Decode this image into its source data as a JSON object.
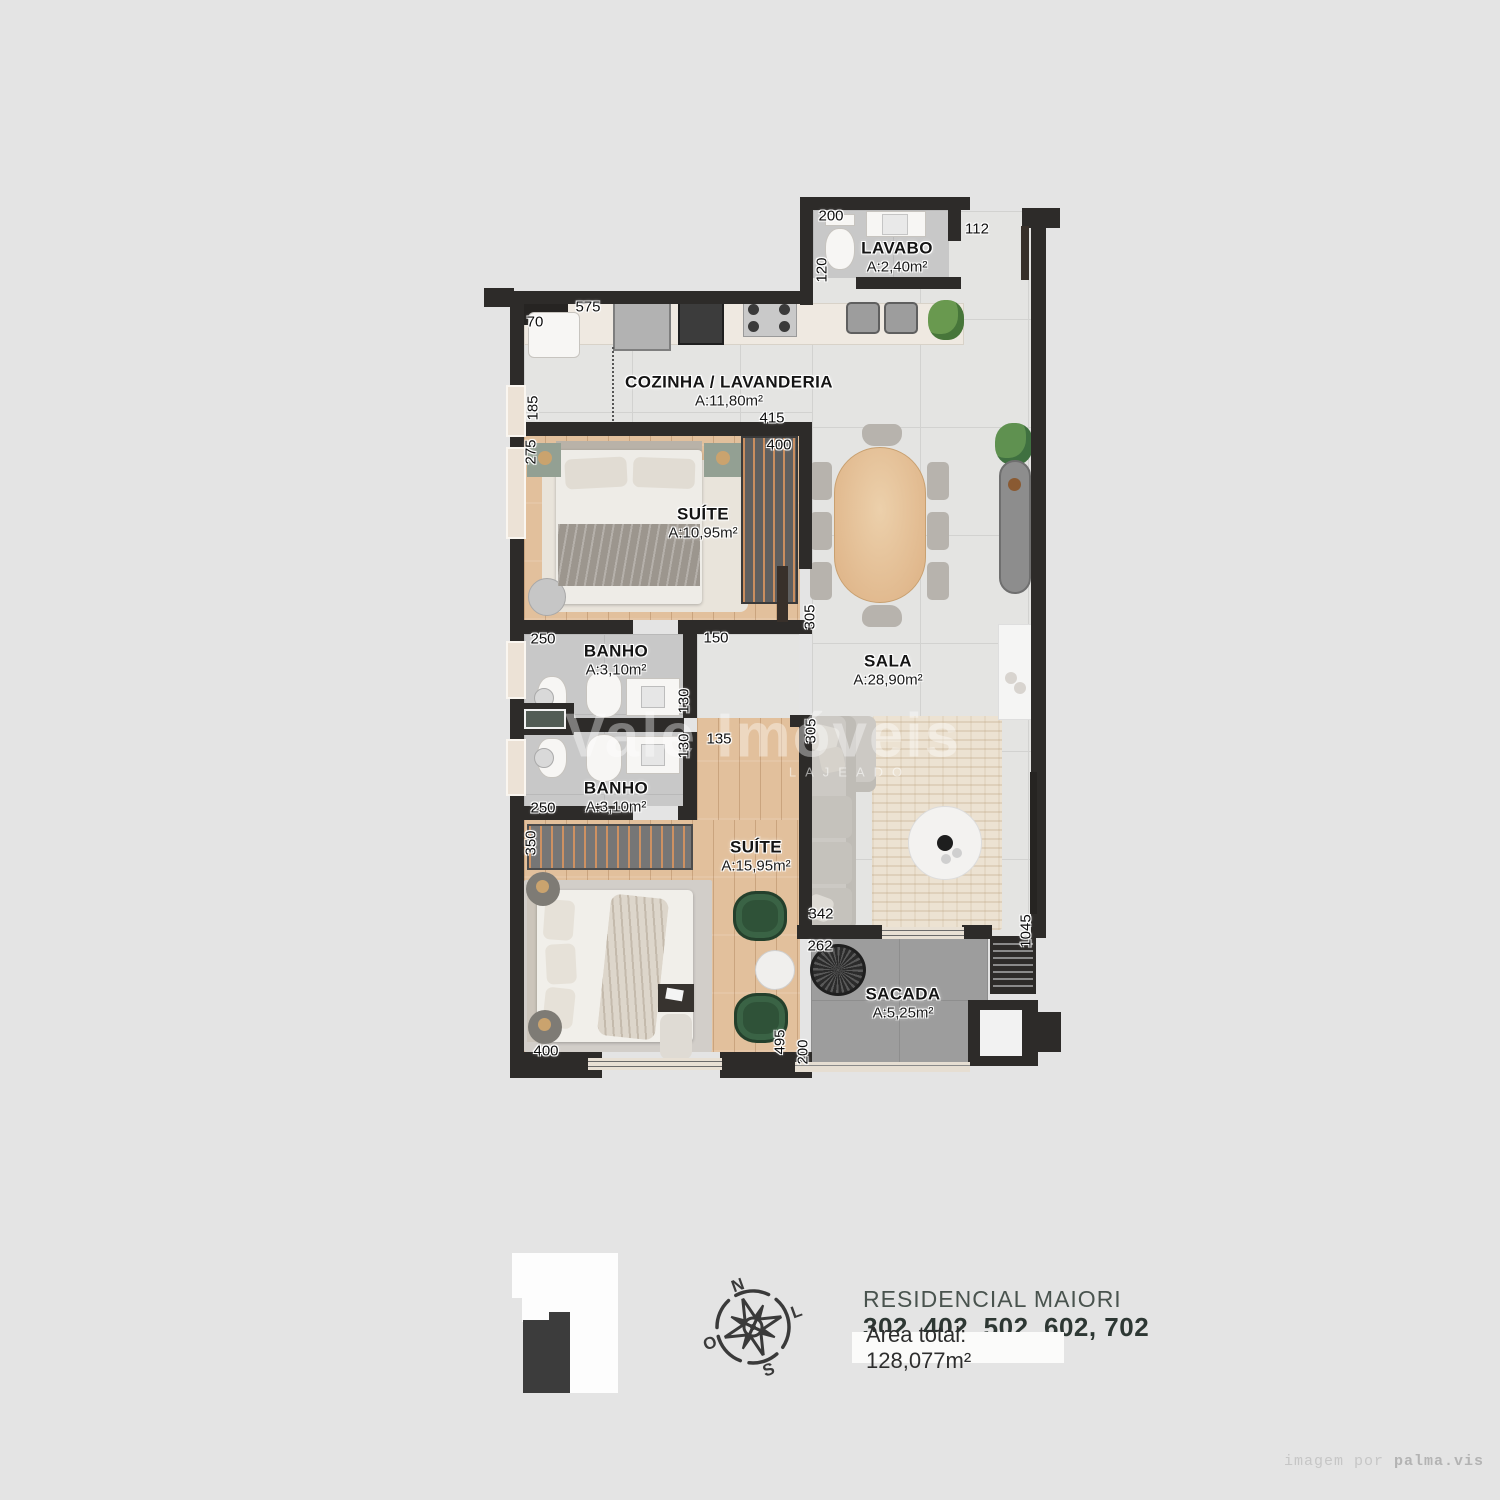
{
  "plan": {
    "rooms": [
      {
        "name": "LAVABO",
        "area": "A:2,40m²"
      },
      {
        "name": "COZINHA / LAVANDERIA",
        "area": "A:11,80m²"
      },
      {
        "name": "SUÍTE",
        "area": "A:10,95m²"
      },
      {
        "name": "BANHO",
        "area": "A:3,10m²"
      },
      {
        "name": "BANHO",
        "area": "A:3,10m²"
      },
      {
        "name": "SUÍTE",
        "area": "A:15,95m²"
      },
      {
        "name": "SALA",
        "area": "A:28,90m²"
      },
      {
        "name": "SACADA",
        "area": "A:5,25m²"
      }
    ],
    "dims": [
      {
        "t": "200"
      },
      {
        "t": "112"
      },
      {
        "t": "120"
      },
      {
        "t": "575"
      },
      {
        "t": "70"
      },
      {
        "t": "185"
      },
      {
        "t": "415"
      },
      {
        "t": "275"
      },
      {
        "t": "400"
      },
      {
        "t": "305"
      },
      {
        "t": "250"
      },
      {
        "t": "150"
      },
      {
        "t": "130"
      },
      {
        "t": "130"
      },
      {
        "t": "135"
      },
      {
        "t": "305"
      },
      {
        "t": "250"
      },
      {
        "t": "350"
      },
      {
        "t": "400"
      },
      {
        "t": "495"
      },
      {
        "t": "342"
      },
      {
        "t": "262"
      },
      {
        "t": "200"
      },
      {
        "t": "1045"
      }
    ],
    "watermark": {
      "main": "Vale Imóveis",
      "sub": "LAJEADO"
    },
    "colors": {
      "wall": "#2d2b29",
      "wood": "#e2c09c",
      "tile": "#e4e4e2",
      "bath_tile": "#c8c8c8",
      "balcony": "#9d9d9d",
      "chair_green": "#2f5238"
    }
  },
  "compass": {
    "n": "N",
    "l": "L",
    "s": "S",
    "o": "O"
  },
  "footer": {
    "title": "RESIDENCIAL MAIORI",
    "units": "302, 402, 502, 602, 702",
    "area_total": "Área total: 128,077m²"
  },
  "credit": {
    "prefix": "imagem por ",
    "brand": "palma.vis"
  }
}
